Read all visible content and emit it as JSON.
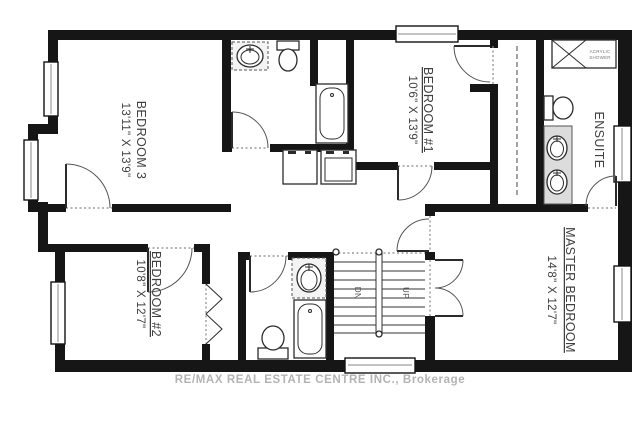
{
  "rooms": {
    "bedroom3": {
      "name": "BEDROOM 3",
      "dims": "13'11\" X 13'9\""
    },
    "bedroom1": {
      "name": "BEDROOM #1",
      "dims": "10'6\" X 13'9\""
    },
    "bedroom2": {
      "name": "BEDROOM #2",
      "dims": "10'8\" X 12'7\""
    },
    "master": {
      "name": "MASTER BEDROOM",
      "dims": "14'8\" X 12'7\""
    },
    "ensuite": {
      "name": "ENSUITE"
    }
  },
  "stairs": {
    "down": "DN",
    "up": "UP"
  },
  "shower": {
    "line1": "ACRYLIC",
    "line2": "SHOWER"
  },
  "watermark": "RE/MAX REAL ESTATE CENTRE INC., Brokerage",
  "colors": {
    "wall": "#161616",
    "fixture_outline": "#2b2b2b",
    "label": "#404040",
    "counter": "#dcdcdc",
    "watermark": "#b3b3b3"
  }
}
